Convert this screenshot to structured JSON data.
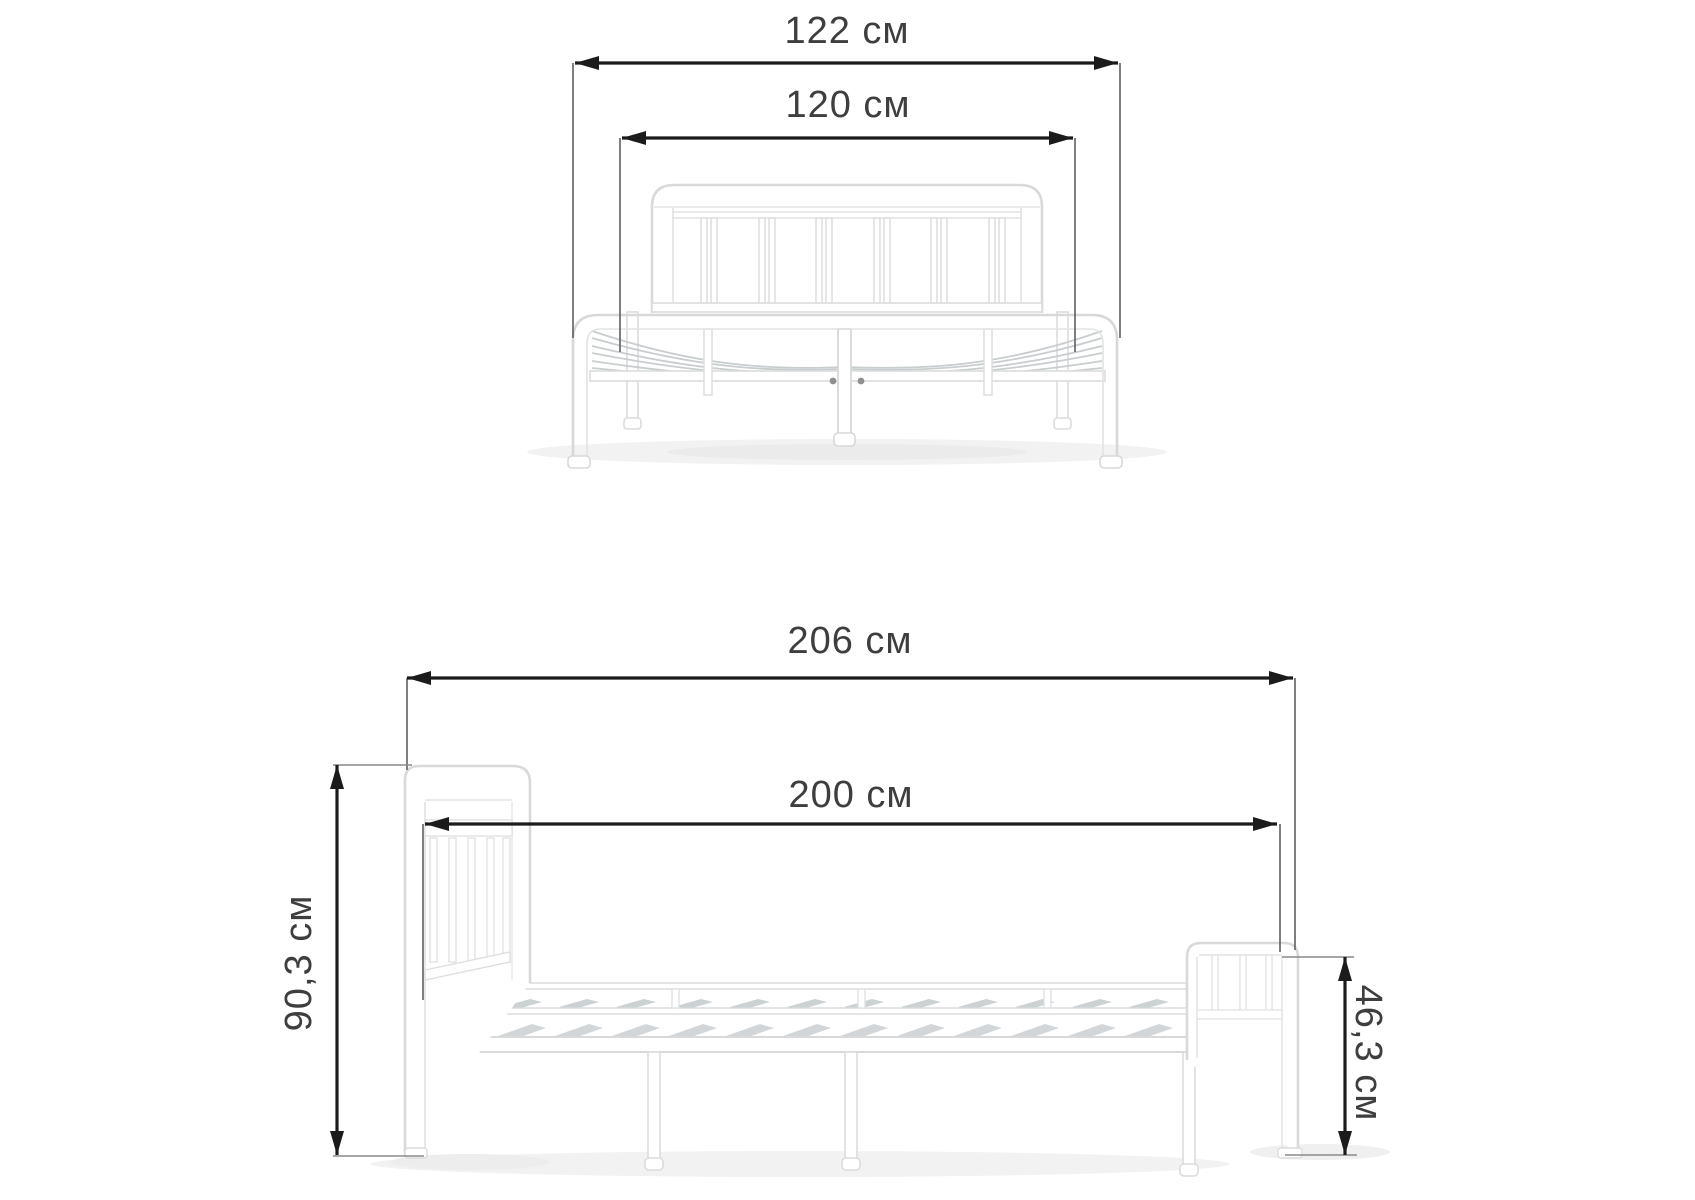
{
  "page": {
    "background": "#ffffff"
  },
  "diagram": {
    "unit": "см",
    "colors": {
      "dimension_line": "#1b1b1b",
      "extension_line": "#5f5f5f",
      "label_text": "#3e3e3e",
      "bed_outline": "#d9d9d9",
      "bed_detail": "#e3e3e3",
      "slat_fill": "#ced3d5",
      "shadow": "#f2f2f2"
    },
    "front_view": {
      "overall_width": {
        "label": "122 см",
        "value_cm": "122"
      },
      "inner_width": {
        "label": "120 см",
        "value_cm": "120"
      }
    },
    "side_view": {
      "overall_length": {
        "label": "206 см",
        "value_cm": "206"
      },
      "inner_length": {
        "label": "200 см",
        "value_cm": "200"
      },
      "headboard_height": {
        "label": "90,3 см",
        "value_cm": "90,3"
      },
      "footboard_height": {
        "label": "46,3 см",
        "value_cm": "46,3"
      }
    }
  }
}
